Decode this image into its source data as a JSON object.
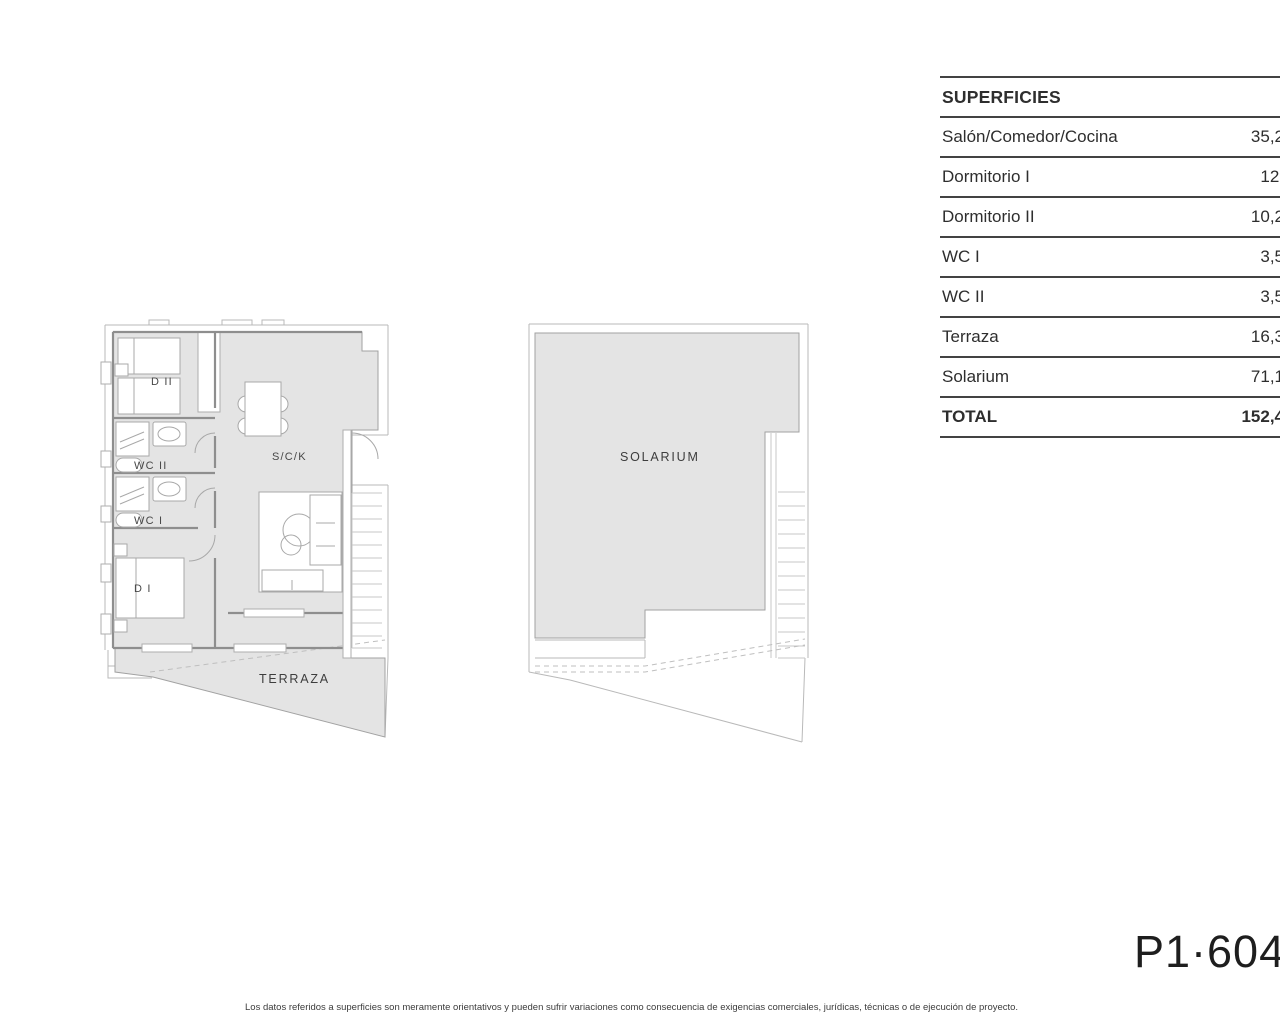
{
  "table": {
    "title": "SUPERFICIES",
    "rows": [
      {
        "label": "Salón/Comedor/Cocina",
        "value": "35,2",
        "bold": false
      },
      {
        "label": "Dormitorio I",
        "value": "12,",
        "bold": false
      },
      {
        "label": "Dormitorio II",
        "value": "10,2",
        "bold": false
      },
      {
        "label": "WC I",
        "value": "3,5",
        "bold": false
      },
      {
        "label": "WC II",
        "value": "3,5",
        "bold": false
      },
      {
        "label": "Terraza",
        "value": "16,3",
        "bold": false
      },
      {
        "label": "Solarium",
        "value": "71,1",
        "bold": false
      },
      {
        "label": "TOTAL",
        "value": "152,4",
        "bold": true
      }
    ]
  },
  "plan1": {
    "rooms": {
      "d2": "D II",
      "wc2": "WC II",
      "wc1": "WC I",
      "d1": "D I",
      "sck": "S/C/K",
      "terraza": "TERRAZA"
    }
  },
  "plan2": {
    "label": "SOLARIUM"
  },
  "footer": {
    "plan_code": "P1·604",
    "disclaimer": "Los datos referidos a superficies son meramente orientativos y pueden sufrir variaciones como consecuencia de exigencias comerciales, jurídicas, técnicas o de ejecución de proyecto."
  },
  "colors": {
    "floor_fill": "#e4e4e4",
    "wall": "#8e8e8e",
    "table_line": "#434343",
    "text": "#2e2e2e"
  }
}
